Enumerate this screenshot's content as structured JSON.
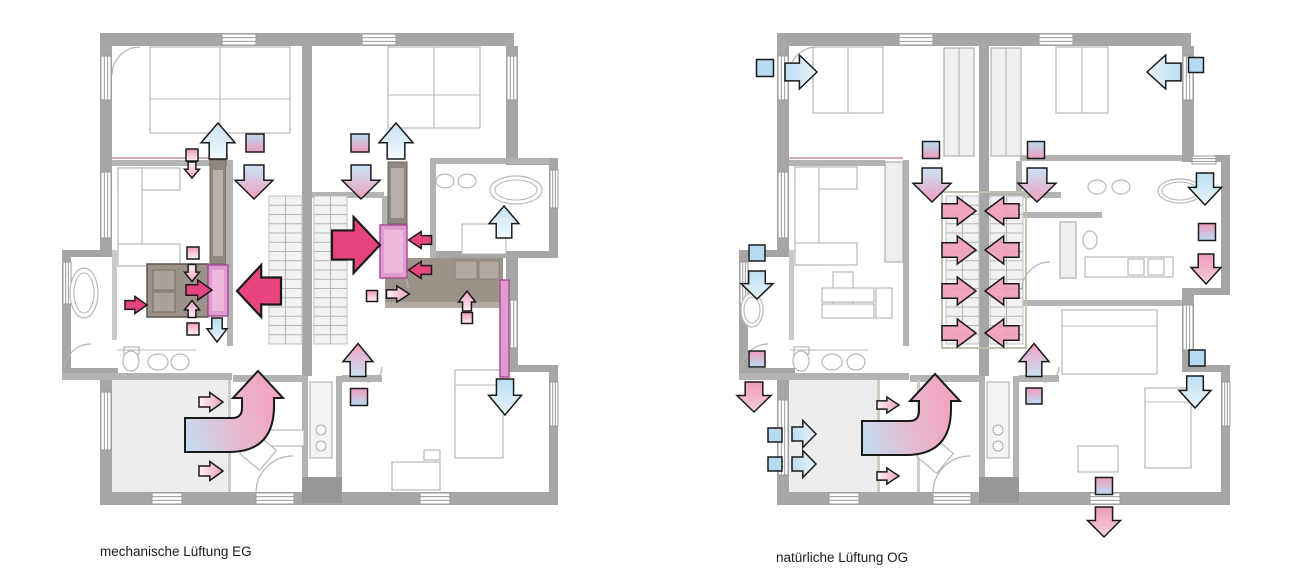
{
  "canvas": {
    "width": 1300,
    "height": 580,
    "background": "#ffffff"
  },
  "figure": {
    "colors": {
      "extract_magenta": "#e8447f",
      "stair_pink": "#ef9cba",
      "cool_blue": "#b5dbf2",
      "supply_blue": "#c7e2f5",
      "transfer_pink": "#efa0bf",
      "wall_gray": "#a6a6a6",
      "dark_room": "#9b9289",
      "duct_pink": "#df9cce",
      "duct_border": "#a94f97"
    },
    "plans": [
      {
        "id": "eg",
        "label": "mechanische Lüftung EG",
        "ducts": [
          {
            "x": 208,
            "y": 265,
            "w": 20,
            "h": 51
          },
          {
            "x": 380,
            "y": 225,
            "w": 27,
            "h": 53
          },
          {
            "x": 500,
            "y": 280,
            "w": 9,
            "h": 97
          }
        ],
        "vents": [
          {
            "x": 255,
            "y": 143,
            "s": 18,
            "f": "bp"
          },
          {
            "x": 360,
            "y": 143,
            "s": 18,
            "f": "bp"
          },
          {
            "x": 192,
            "y": 155,
            "s": 12,
            "f": "warm"
          },
          {
            "x": 193,
            "y": 253,
            "s": 12,
            "f": "warm"
          },
          {
            "x": 193,
            "y": 329,
            "s": 12,
            "f": "warm"
          },
          {
            "x": 372,
            "y": 296,
            "s": 11,
            "f": "warm"
          },
          {
            "x": 467,
            "y": 318,
            "s": 11,
            "f": "warm"
          },
          {
            "x": 359,
            "y": 397,
            "s": 17,
            "f": "pb"
          }
        ],
        "arrows": [
          {
            "d": "up",
            "x": 218,
            "y": 141,
            "l": 36,
            "w": 34,
            "f": "blue"
          },
          {
            "d": "up",
            "x": 396,
            "y": 141,
            "l": 36,
            "w": 34,
            "f": "blue"
          },
          {
            "d": "up",
            "x": 504,
            "y": 222,
            "l": 32,
            "w": 30,
            "f": "blue"
          },
          {
            "d": "down",
            "x": 254,
            "y": 182,
            "l": 34,
            "w": 38,
            "f": "bp"
          },
          {
            "d": "down",
            "x": 361,
            "y": 182,
            "l": 34,
            "w": 38,
            "f": "bp"
          },
          {
            "d": "down",
            "x": 192,
            "y": 170,
            "l": 16,
            "w": 15,
            "f": "pink"
          },
          {
            "d": "down",
            "x": 192,
            "y": 273,
            "l": 17,
            "w": 15,
            "f": "pink"
          },
          {
            "d": "up",
            "x": 192,
            "y": 309,
            "l": 17,
            "w": 15,
            "f": "pink"
          },
          {
            "d": "right",
            "x": 199,
            "y": 290,
            "l": 26,
            "w": 20,
            "f": "mag"
          },
          {
            "d": "right",
            "x": 136,
            "y": 305,
            "l": 22,
            "w": 17,
            "f": "mag"
          },
          {
            "d": "down",
            "x": 217,
            "y": 330,
            "l": 24,
            "w": 20,
            "f": "blue2"
          },
          {
            "d": "left",
            "x": 259,
            "y": 291,
            "l": 44,
            "w": 52,
            "f": "mag",
            "s": 2.2
          },
          {
            "d": "right",
            "x": 356,
            "y": 245,
            "l": 48,
            "w": 56,
            "f": "mag",
            "s": 2.2
          },
          {
            "d": "left",
            "x": 420,
            "y": 240,
            "l": 23,
            "w": 17,
            "f": "mag"
          },
          {
            "d": "left",
            "x": 420,
            "y": 270,
            "l": 23,
            "w": 17,
            "f": "mag"
          },
          {
            "d": "right",
            "x": 398,
            "y": 294,
            "l": 23,
            "w": 16,
            "f": "pink"
          },
          {
            "d": "up",
            "x": 467,
            "y": 301,
            "l": 20,
            "w": 17,
            "f": "pink"
          },
          {
            "d": "up",
            "x": 358,
            "y": 360,
            "l": 33,
            "w": 30,
            "f": "bp"
          },
          {
            "d": "down",
            "x": 505,
            "y": 397,
            "l": 36,
            "w": 33,
            "f": "blue2"
          },
          {
            "d": "right",
            "x": 211,
            "y": 402,
            "l": 24,
            "w": 19,
            "f": "pink"
          },
          {
            "d": "right",
            "x": 211,
            "y": 471,
            "l": 24,
            "w": 19,
            "f": "pink"
          },
          {
            "kind": "curved",
            "x": 185,
            "y": 418
          }
        ]
      },
      {
        "id": "og",
        "label": "natürliche Lüftung OG",
        "vents": [
          {
            "x": 765,
            "y": 68,
            "s": 17,
            "f": "cool"
          },
          {
            "x": 1196,
            "y": 65,
            "s": 15,
            "f": "cool"
          },
          {
            "x": 931,
            "y": 150,
            "s": 17,
            "f": "bp"
          },
          {
            "x": 1036,
            "y": 150,
            "s": 17,
            "f": "bp"
          },
          {
            "x": 757,
            "y": 253,
            "s": 16,
            "f": "cool"
          },
          {
            "x": 1207,
            "y": 232,
            "s": 17,
            "f": "pb"
          },
          {
            "x": 757,
            "y": 359,
            "s": 16,
            "f": "pb"
          },
          {
            "x": 775,
            "y": 435,
            "s": 14,
            "f": "cool"
          },
          {
            "x": 775,
            "y": 464,
            "s": 14,
            "f": "cool"
          },
          {
            "x": 1034,
            "y": 396,
            "s": 16,
            "f": "pb"
          },
          {
            "x": 1104,
            "y": 486,
            "s": 17,
            "f": "pb"
          },
          {
            "x": 1197,
            "y": 358,
            "s": 16,
            "f": "cool"
          }
        ],
        "arrows": [
          {
            "d": "right",
            "x": 801,
            "y": 72,
            "l": 32,
            "w": 34,
            "f": "blue2"
          },
          {
            "d": "left",
            "x": 1164,
            "y": 72,
            "l": 34,
            "w": 34,
            "f": "blue2"
          },
          {
            "d": "down",
            "x": 932,
            "y": 185,
            "l": 34,
            "w": 38,
            "f": "bp"
          },
          {
            "d": "down",
            "x": 1037,
            "y": 185,
            "l": 34,
            "w": 38,
            "f": "bp"
          },
          {
            "d": "right",
            "x": 959,
            "y": 211,
            "l": 34,
            "w": 28,
            "f": "stair"
          },
          {
            "d": "left",
            "x": 1002,
            "y": 211,
            "l": 34,
            "w": 28,
            "f": "stair"
          },
          {
            "d": "right",
            "x": 959,
            "y": 250,
            "l": 34,
            "w": 28,
            "f": "stair"
          },
          {
            "d": "left",
            "x": 1002,
            "y": 250,
            "l": 34,
            "w": 28,
            "f": "stair"
          },
          {
            "d": "right",
            "x": 959,
            "y": 291,
            "l": 34,
            "w": 28,
            "f": "stair"
          },
          {
            "d": "left",
            "x": 1002,
            "y": 291,
            "l": 34,
            "w": 28,
            "f": "stair"
          },
          {
            "d": "right",
            "x": 959,
            "y": 333,
            "l": 34,
            "w": 28,
            "f": "stair"
          },
          {
            "d": "left",
            "x": 1002,
            "y": 333,
            "l": 34,
            "w": 28,
            "f": "stair"
          },
          {
            "d": "down",
            "x": 1205,
            "y": 189,
            "l": 32,
            "w": 33,
            "f": "blue2"
          },
          {
            "d": "down",
            "x": 1206,
            "y": 269,
            "l": 30,
            "w": 30,
            "f": "pinkfade"
          },
          {
            "d": "down",
            "x": 757,
            "y": 285,
            "l": 28,
            "w": 32,
            "f": "blue2"
          },
          {
            "d": "down",
            "x": 754,
            "y": 397,
            "l": 30,
            "w": 34,
            "f": "pinkfade"
          },
          {
            "d": "right",
            "x": 804,
            "y": 434,
            "l": 24,
            "w": 27,
            "f": "blue2"
          },
          {
            "d": "right",
            "x": 804,
            "y": 464,
            "l": 24,
            "w": 27,
            "f": "blue2"
          },
          {
            "d": "right",
            "x": 888,
            "y": 405,
            "l": 22,
            "w": 16,
            "f": "pink"
          },
          {
            "d": "right",
            "x": 888,
            "y": 476,
            "l": 22,
            "w": 16,
            "f": "pink"
          },
          {
            "d": "up",
            "x": 1034,
            "y": 360,
            "l": 33,
            "w": 30,
            "f": "bp"
          },
          {
            "d": "down",
            "x": 1195,
            "y": 392,
            "l": 32,
            "w": 32,
            "f": "blue2"
          },
          {
            "d": "down",
            "x": 1104,
            "y": 522,
            "l": 30,
            "w": 33,
            "f": "pinkfade"
          },
          {
            "kind": "curved",
            "x": 862,
            "y": 421
          }
        ]
      }
    ]
  }
}
